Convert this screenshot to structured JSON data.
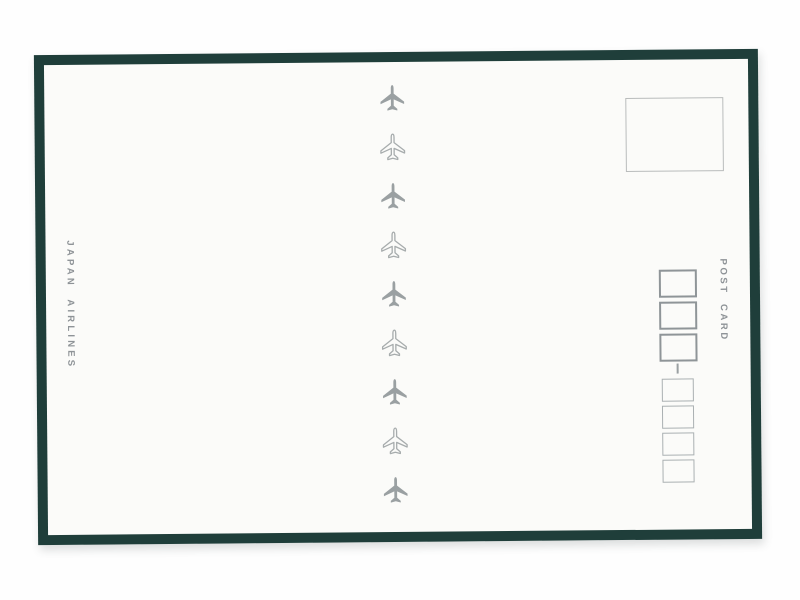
{
  "postcard": {
    "brand_vertical_text": "JAPAN AIRLINES",
    "postcard_vertical_text": "POST CARD",
    "plane_column": {
      "count": 9,
      "orientation": "pointing-up",
      "pattern": [
        "filled",
        "outline",
        "filled",
        "outline",
        "filled",
        "outline",
        "filled",
        "outline",
        "filled"
      ]
    },
    "stamp_box": {
      "present": true,
      "content": ""
    },
    "postal_code": {
      "large_box_count": 3,
      "small_box_count": 4,
      "separator": "dash"
    },
    "colors": {
      "frame_green": "#1f3e3a",
      "card_white": "#fbfbf9",
      "scan_background": "#fefefe",
      "plane_filled_grey": "#9aa0a2",
      "plane_outline_grey": "#a7acad",
      "text_grey": "#8e9397",
      "stamp_border": "#b9bcbc",
      "zip_large_border": "#8f9598",
      "zip_small_border": "#aab0b2",
      "dash_grey": "#9aa0a2"
    }
  }
}
